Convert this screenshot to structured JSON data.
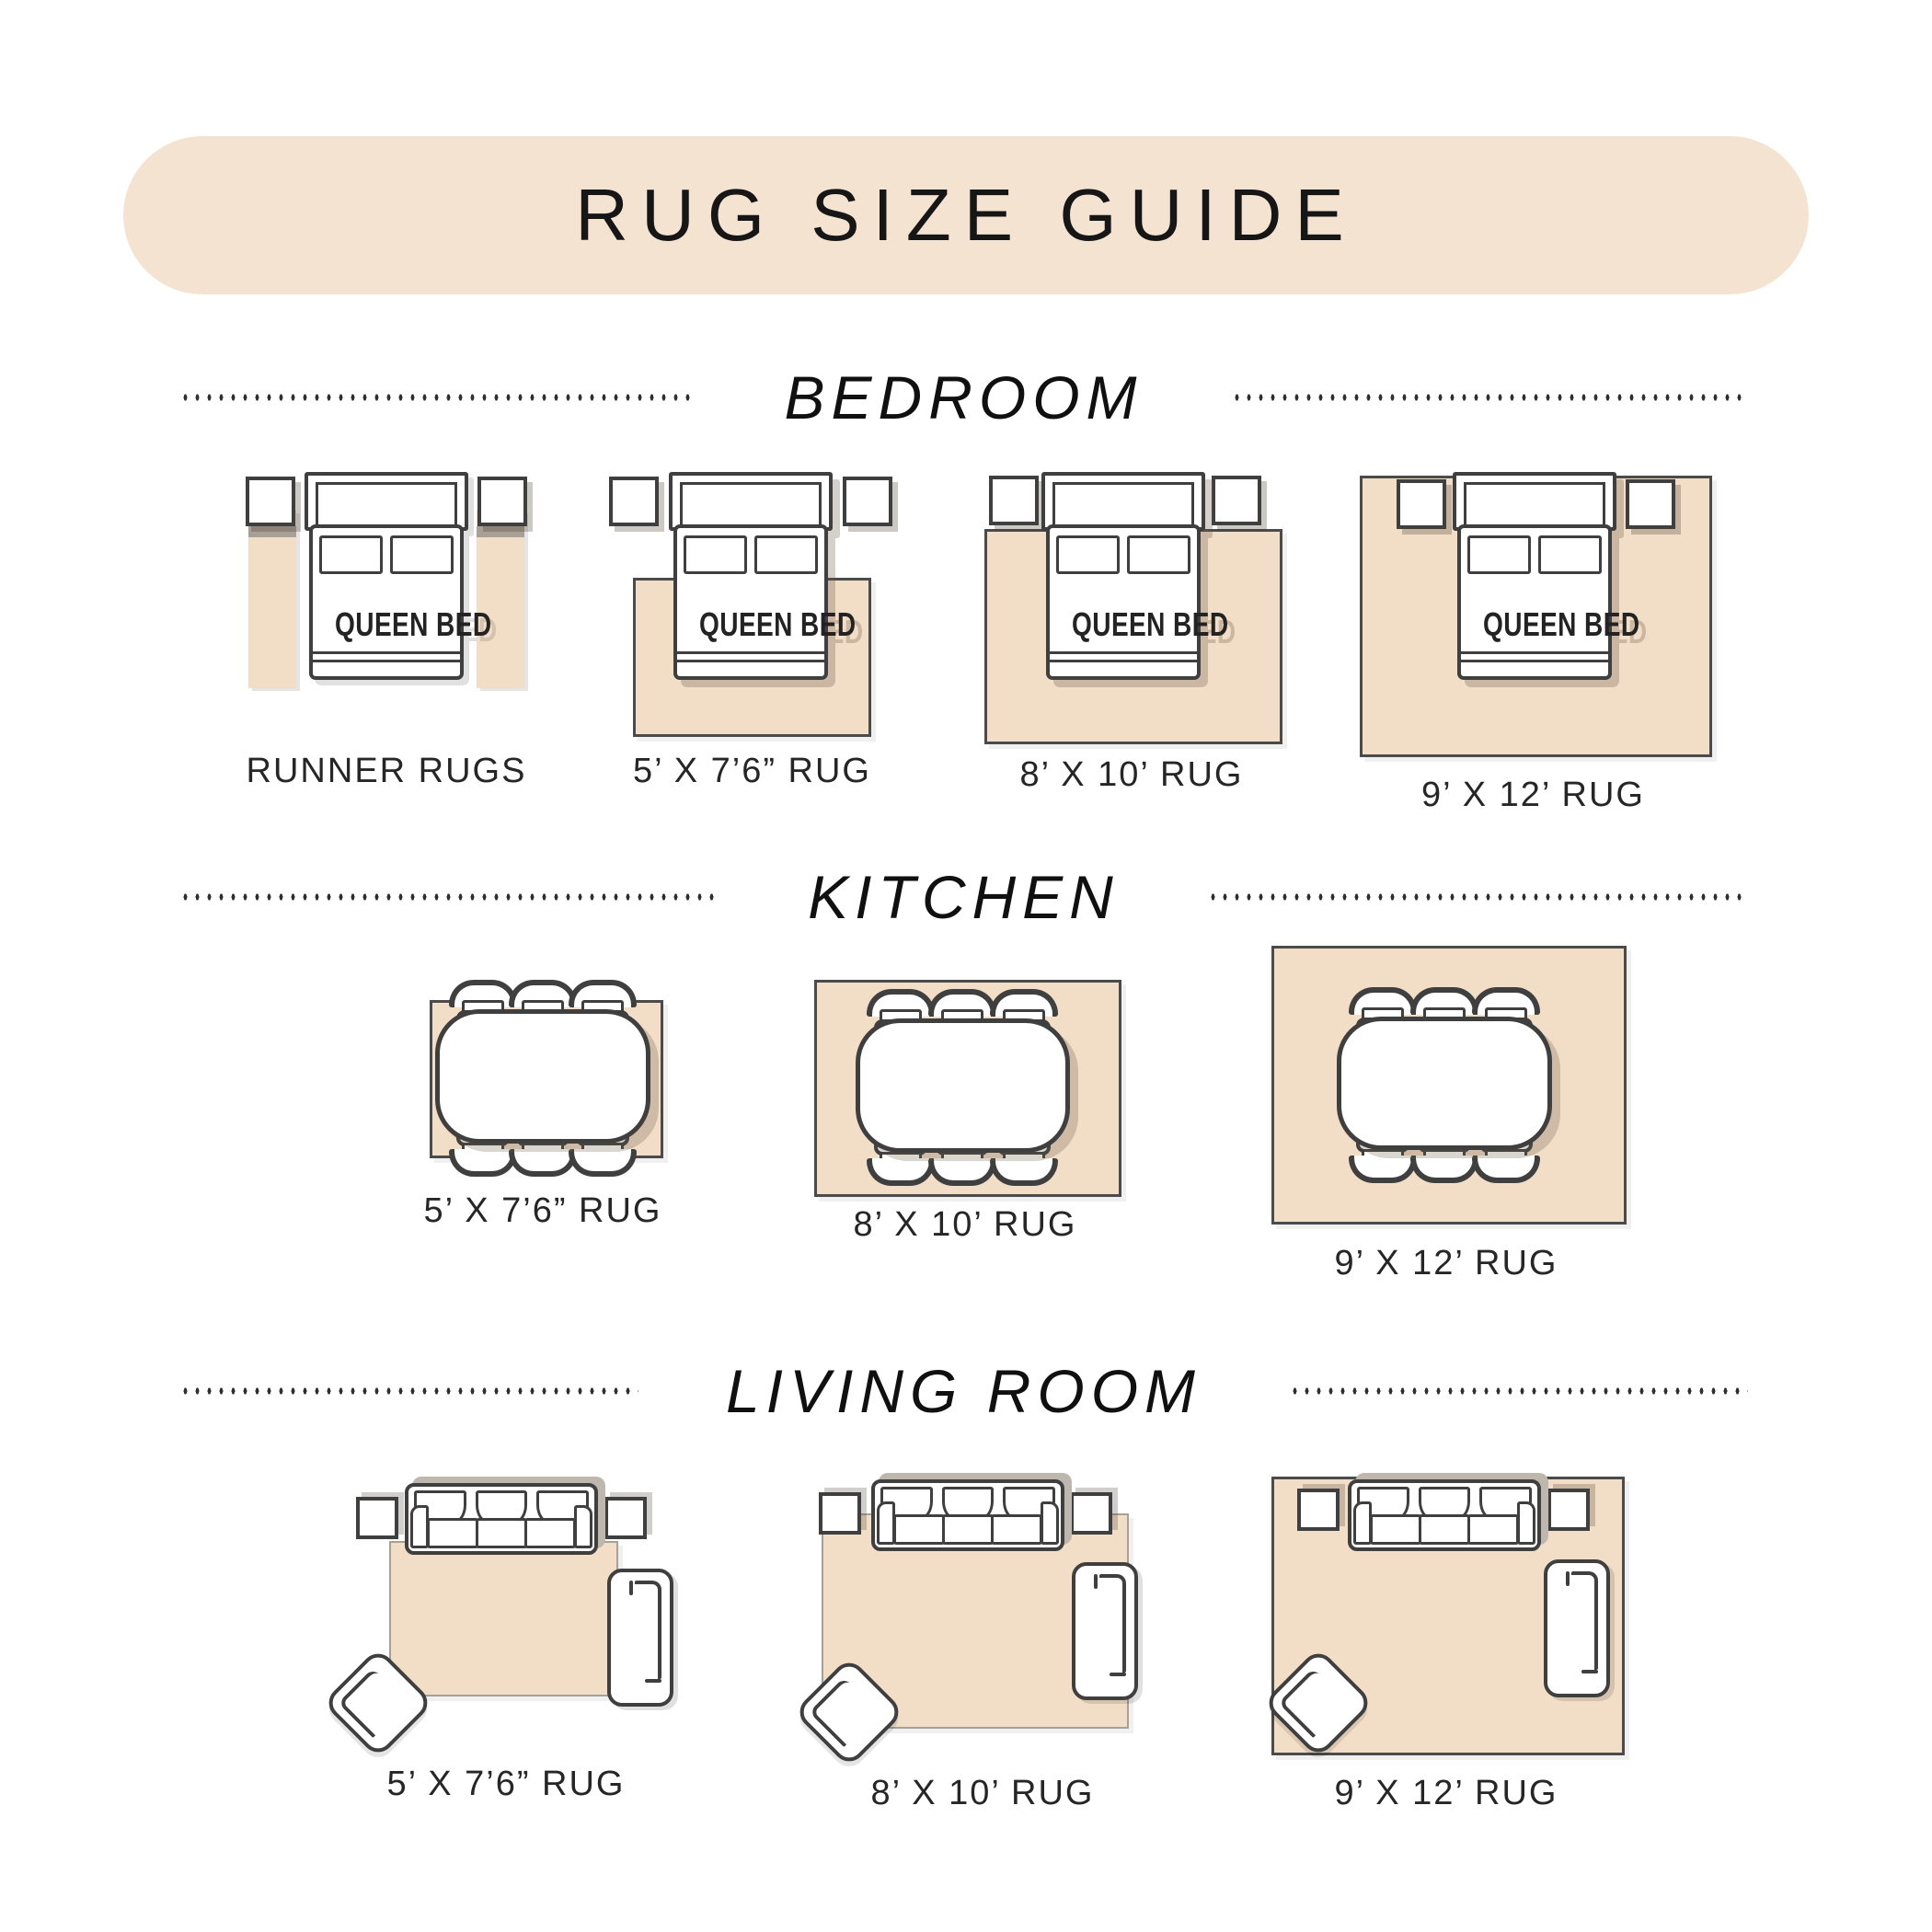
{
  "title": "RUG SIZE GUIDE",
  "bed_label": "QUEEN BED",
  "sections": [
    {
      "name": "BEDROOM",
      "items": [
        {
          "label": "RUNNER RUGS"
        },
        {
          "label": "5’ X 7’6” RUG"
        },
        {
          "label": "8’ X 10’ RUG"
        },
        {
          "label": "9’ X 12’ RUG"
        }
      ]
    },
    {
      "name": "KITCHEN",
      "items": [
        {
          "label": "5’ X 7’6” RUG"
        },
        {
          "label": "8’ X 10’ RUG"
        },
        {
          "label": "9’ X 12’ RUG"
        }
      ]
    },
    {
      "name": "LIVING ROOM",
      "items": [
        {
          "label": "5’ X 7’6” RUG"
        },
        {
          "label": "8’ X 10’ RUG"
        },
        {
          "label": "9’ X 12’ RUG"
        }
      ]
    }
  ],
  "colors": {
    "banner_beige": "#f5e3d1",
    "rug_beige": "#f2ddc7",
    "outline_dark": "#3f3f3f",
    "dot_color": "#2e2e2e",
    "label_text": "#262626"
  }
}
